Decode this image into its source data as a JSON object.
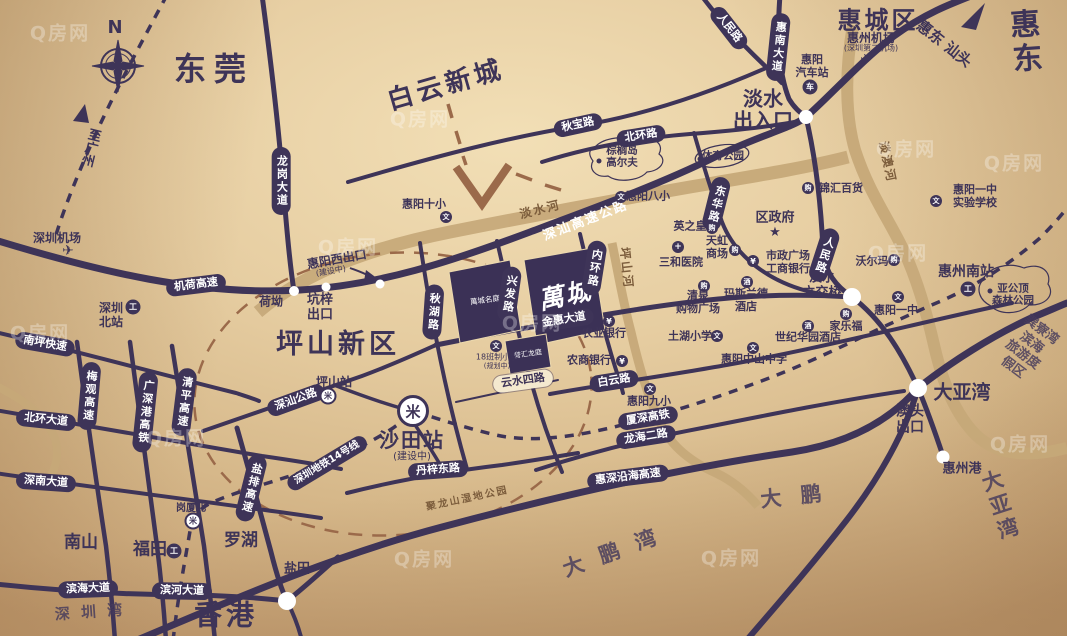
{
  "watermark": "Q房网",
  "compass": {
    "n": "N"
  },
  "project": {
    "name": "萬城",
    "logo": "萬城名庭",
    "mini": "誉汇龙庭"
  },
  "colors": {
    "road": "#3e3458",
    "river": "#c6a878",
    "accent_dash": "#9b6a4a",
    "block": "#3b3156",
    "bg": "#e3cba0"
  },
  "big": [
    {
      "n": "compass-n",
      "t": "N",
      "x": 115,
      "y": 28,
      "s": 18
    },
    {
      "n": "dongguan",
      "t": "东莞",
      "x": 214,
      "y": 70,
      "s": 32,
      "ls": 8
    },
    {
      "n": "baiyun-new-town",
      "t": "白云新城",
      "x": 446,
      "y": 86,
      "s": 26,
      "r": -16,
      "ls": 4
    },
    {
      "n": "huicheng-district",
      "t": "惠城区",
      "x": 878,
      "y": 21,
      "s": 24,
      "ls": 3
    },
    {
      "n": "huidong",
      "t": "惠东",
      "x": 1029,
      "y": 42,
      "s": 30,
      "r": -4,
      "ls": 5
    },
    {
      "n": "huidong-shantou",
      "t": "惠东 汕头",
      "x": 944,
      "y": 44,
      "s": 15,
      "r": 38
    },
    {
      "n": "danshui-entrance",
      "t": "淡水\n出入口",
      "x": 763,
      "y": 110,
      "s": 20
    },
    {
      "n": "pingshan-new-district",
      "t": "坪山新区",
      "x": 338,
      "y": 345,
      "s": 27,
      "ls": 4
    },
    {
      "n": "to-guangzhou",
      "t": "至广州",
      "x": 89,
      "y": 147,
      "s": 13,
      "r": 14,
      "v": 1
    },
    {
      "n": "heao",
      "t": "荷坳",
      "x": 271,
      "y": 302,
      "s": 12
    },
    {
      "n": "kengzi-exit",
      "t": "坑梓\n出口",
      "x": 320,
      "y": 308,
      "s": 13
    },
    {
      "n": "huiyang-west-exit",
      "t": "惠阳西出口",
      "x": 337,
      "y": 260,
      "s": 12,
      "r": -10
    },
    {
      "n": "huiyang-west-exit-status",
      "t": "(建设中)",
      "x": 331,
      "y": 272,
      "s": 8,
      "r": -10,
      "fw": 400
    },
    {
      "n": "danshui-interchange",
      "t": "淡水\n立交桥",
      "x": 822,
      "y": 286,
      "s": 13
    },
    {
      "n": "shatian-station",
      "t": "沙田站",
      "x": 412,
      "y": 440,
      "s": 20,
      "ls": 2
    },
    {
      "n": "shatian-station-status",
      "t": "(建设中)",
      "x": 412,
      "y": 457,
      "s": 10,
      "fw": 400
    },
    {
      "n": "huizhou-south-station",
      "t": "惠州南站",
      "x": 966,
      "y": 273,
      "s": 14
    },
    {
      "n": "daya-bay-junction",
      "t": "大亚湾",
      "x": 962,
      "y": 393,
      "s": 19
    },
    {
      "n": "aotou-exit",
      "t": "澳头\n出口",
      "x": 910,
      "y": 420,
      "s": 14
    },
    {
      "n": "huizhou-port",
      "t": "惠州港",
      "x": 962,
      "y": 470,
      "s": 13
    },
    {
      "n": "nanshan",
      "t": "南山",
      "x": 81,
      "y": 543,
      "s": 17
    },
    {
      "n": "futian",
      "t": "福田",
      "x": 150,
      "y": 550,
      "s": 17
    },
    {
      "n": "luohu",
      "t": "罗湖",
      "x": 241,
      "y": 541,
      "s": 17
    },
    {
      "n": "yantian",
      "t": "盐田",
      "x": 297,
      "y": 570,
      "s": 13
    },
    {
      "n": "hongkong",
      "t": "香港",
      "x": 226,
      "y": 615,
      "s": 28,
      "ls": 4
    }
  ],
  "sea": [
    {
      "n": "shenzhen-bay",
      "t": "深 圳 湾",
      "x": 90,
      "y": 612,
      "s": 15,
      "r": -4,
      "ls": 3
    },
    {
      "n": "dapeng",
      "t": "大 鹏",
      "x": 794,
      "y": 497,
      "s": 21,
      "r": -6,
      "ls": 6
    },
    {
      "n": "dapeng-bay",
      "t": "大 鹏 湾",
      "x": 612,
      "y": 553,
      "s": 21,
      "r": -20,
      "ls": 5
    },
    {
      "n": "daya-bay-sea",
      "t": "大 亚 湾",
      "x": 1003,
      "y": 505,
      "s": 21,
      "r": -18,
      "ls": 5
    },
    {
      "n": "xunliao-resort",
      "t": "巽寮湾滨海\n旅游度假区",
      "x": 1027,
      "y": 349,
      "s": 13,
      "r": 37
    }
  ],
  "pills": [
    {
      "n": "jihe-expwy",
      "t": "机荷高速",
      "x": 196,
      "y": 285,
      "r": -7
    },
    {
      "n": "longgang-ave",
      "t": "龙岗大道",
      "x": 281,
      "y": 181,
      "v": 1
    },
    {
      "n": "nanping-expwy",
      "t": "南坪快速",
      "x": 45,
      "y": 344,
      "r": 10
    },
    {
      "n": "meiguan-expwy",
      "t": "梅观高速",
      "x": 89,
      "y": 396,
      "v": 1,
      "r": 5
    },
    {
      "n": "guangshengang-hsr",
      "t": "广深港高铁",
      "x": 145,
      "y": 412,
      "v": 1,
      "r": 6
    },
    {
      "n": "qingping-expwy",
      "t": "清平高速",
      "x": 184,
      "y": 402,
      "v": 1,
      "r": 7
    },
    {
      "n": "beihuan-ave",
      "t": "北环大道",
      "x": 46,
      "y": 420,
      "r": 6
    },
    {
      "n": "shennan-ave",
      "t": "深南大道",
      "x": 46,
      "y": 482,
      "r": 4
    },
    {
      "n": "yanpai-expwy",
      "t": "盐排高速",
      "x": 251,
      "y": 488,
      "v": 1,
      "r": 14
    },
    {
      "n": "binhai-ave",
      "t": "滨海大道",
      "x": 88,
      "y": 589,
      "r": -2
    },
    {
      "n": "binhe-ave",
      "t": "滨河大道",
      "x": 182,
      "y": 591,
      "r": 1
    },
    {
      "n": "qiubao-rd",
      "t": "秋宝路",
      "x": 578,
      "y": 125,
      "r": -12
    },
    {
      "n": "beihuan-rd",
      "t": "北环路",
      "x": 641,
      "y": 136,
      "r": -9
    },
    {
      "n": "qiuhu-rd",
      "t": "秋湖路",
      "x": 433,
      "y": 312,
      "v": 1,
      "r": 4
    },
    {
      "n": "xingfa-rd",
      "t": "兴发路",
      "x": 509,
      "y": 294,
      "v": 1,
      "r": 8
    },
    {
      "n": "neihuan-rd",
      "t": "内环路",
      "x": 594,
      "y": 268,
      "v": 1,
      "r": 9
    },
    {
      "n": "jinhui-ave",
      "t": "金惠大道",
      "x": 564,
      "y": 320,
      "r": -9
    },
    {
      "n": "baiyun-rd",
      "t": "白云路",
      "x": 614,
      "y": 381,
      "r": -9
    },
    {
      "n": "xiashen-hsr",
      "t": "厦深高铁",
      "x": 648,
      "y": 418,
      "r": -9
    },
    {
      "n": "longhai-2-rd",
      "t": "龙海二路",
      "x": 646,
      "y": 437,
      "r": -9
    },
    {
      "n": "huishen-coastal-expwy",
      "t": "惠深沿海高速",
      "x": 628,
      "y": 477,
      "r": -7
    },
    {
      "n": "danzi-east-rd",
      "t": "丹梓东路",
      "x": 438,
      "y": 470,
      "r": -4
    },
    {
      "n": "shenshan-rd",
      "t": "深汕公路",
      "x": 296,
      "y": 400,
      "r": -20
    },
    {
      "n": "metro-line-14",
      "t": "深圳地铁14号线",
      "x": 327,
      "y": 463,
      "r": -31,
      "s": 10
    },
    {
      "n": "donghua-rd",
      "t": "东华路",
      "x": 716,
      "y": 204,
      "v": 1,
      "r": 14
    },
    {
      "n": "renmin-rd-mid",
      "t": "人民路",
      "x": 824,
      "y": 255,
      "v": 1,
      "r": 18
    },
    {
      "n": "renmin-rd-top",
      "t": "人民路",
      "x": 729,
      "y": 28,
      "r": 52
    },
    {
      "n": "huinan-ave",
      "t": "惠南大道",
      "x": 778,
      "y": 47,
      "v": 1,
      "r": 6
    },
    {
      "n": "yunshui-4-rd",
      "t": "云水四路",
      "x": 523,
      "y": 381,
      "r": -8,
      "light": 1
    }
  ],
  "road_texts": [
    {
      "n": "shenshan-expressway",
      "t": "深汕高速公路",
      "x": 585,
      "y": 219,
      "r": -21,
      "s": 13
    }
  ],
  "river_texts": [
    {
      "n": "danshui-river",
      "t": "淡水河",
      "x": 540,
      "y": 209,
      "r": -14,
      "s": 12
    },
    {
      "n": "danao-river",
      "t": "淡澳河",
      "x": 888,
      "y": 162,
      "r": 78,
      "s": 12
    },
    {
      "n": "pingshan-river",
      "t": "坪山河",
      "x": 627,
      "y": 268,
      "r": 84,
      "s": 12
    },
    {
      "n": "julongshan-wetland-park",
      "t": "聚龙山湿地公园",
      "x": 467,
      "y": 497,
      "r": -12,
      "s": 10
    }
  ],
  "pois": [
    {
      "n": "huizhou-airport",
      "t": "惠州机场",
      "x": 871,
      "y": 38,
      "s": 12
    },
    {
      "n": "huizhou-airport-sub",
      "t": "(深圳第二机场)",
      "x": 871,
      "y": 48,
      "s": 8,
      "fw": 400
    },
    {
      "n": "huiyang-bus-station",
      "t": "惠阳\n汽车站",
      "x": 812,
      "y": 67,
      "s": 11
    },
    {
      "n": "palm-island-golf",
      "t": "棕榈岛\n高尔夫",
      "x": 622,
      "y": 157,
      "s": 10.5
    },
    {
      "n": "sports-park",
      "t": "体育公园",
      "x": 723,
      "y": 156,
      "s": 10.5
    },
    {
      "n": "district-government",
      "t": "区政府",
      "x": 775,
      "y": 218,
      "s": 13
    },
    {
      "n": "huiyang-8-school",
      "t": "惠阳八小",
      "x": 648,
      "y": 197,
      "s": 11
    },
    {
      "n": "huiyang-10-school",
      "t": "惠阳十小",
      "x": 424,
      "y": 205,
      "s": 11
    },
    {
      "n": "jinhui-department-store",
      "t": "锦汇百货",
      "x": 841,
      "y": 189,
      "s": 11
    },
    {
      "n": "huiyang-no1-experimental-school",
      "t": "惠阳一中\n实验学校",
      "x": 975,
      "y": 197,
      "s": 11
    },
    {
      "n": "yingzhihuang",
      "t": "英之皇",
      "x": 690,
      "y": 227,
      "s": 11
    },
    {
      "n": "tianhong-mall",
      "t": "天虹\n商场",
      "x": 717,
      "y": 248,
      "s": 11
    },
    {
      "n": "sanhe-hospital",
      "t": "三和医院",
      "x": 681,
      "y": 263,
      "s": 11
    },
    {
      "n": "civic-plaza-icbc",
      "t": "市政广场\n工商银行",
      "x": 788,
      "y": 263,
      "s": 11
    },
    {
      "n": "walmart",
      "t": "沃尔玛",
      "x": 872,
      "y": 262,
      "s": 11
    },
    {
      "n": "qingquan-mall",
      "t": "清泉\n购物广场",
      "x": 698,
      "y": 303,
      "s": 11
    },
    {
      "n": "maslande-hotel",
      "t": "玛斯兰德\n酒店",
      "x": 746,
      "y": 301,
      "s": 11
    },
    {
      "n": "huiyang-no1-school",
      "t": "惠阳一中",
      "x": 896,
      "y": 311,
      "s": 11
    },
    {
      "n": "carrefour",
      "t": "家乐福",
      "x": 846,
      "y": 327,
      "s": 11
    },
    {
      "n": "tuhu-school",
      "t": "土湖小学",
      "x": 690,
      "y": 337,
      "s": 11
    },
    {
      "n": "century-garden-hotel",
      "t": "世纪华园酒店",
      "x": 808,
      "y": 338,
      "s": 11
    },
    {
      "n": "zhongshan-school",
      "t": "惠阳中山中学",
      "x": 754,
      "y": 360,
      "s": 11
    },
    {
      "n": "agri-bank",
      "t": "农业银行",
      "x": 604,
      "y": 334,
      "s": 11
    },
    {
      "n": "rural-commercial-bank",
      "t": "农商银行",
      "x": 589,
      "y": 361,
      "s": 11
    },
    {
      "n": "huiyang-9-school",
      "t": "惠阳九小",
      "x": 649,
      "y": 402,
      "s": 11
    },
    {
      "n": "yagongding-forest-park",
      "t": "亚公顶\n森林公园",
      "x": 1013,
      "y": 295,
      "s": 10.5
    },
    {
      "n": "shenzhen-airport",
      "t": "深圳机场",
      "x": 57,
      "y": 238,
      "s": 12
    },
    {
      "n": "shenzhen-north-station",
      "t": "深圳\n北站",
      "x": 111,
      "y": 315,
      "s": 12
    },
    {
      "n": "pingshan-station",
      "t": "坪山站",
      "x": 334,
      "y": 382,
      "s": 12
    },
    {
      "n": "gangxia-north",
      "t": "岗厦北",
      "x": 191,
      "y": 509,
      "s": 10
    },
    {
      "n": "planned-school",
      "t": "18班制小学",
      "x": 497,
      "y": 357,
      "s": 8,
      "fw": 400
    },
    {
      "n": "planned-school-sub",
      "t": "(规划中)",
      "x": 497,
      "y": 366,
      "s": 7,
      "fw": 400
    }
  ],
  "icons": [
    {
      "n": "shenzhen-airport-icon",
      "t": "plane",
      "x": 68,
      "y": 251
    },
    {
      "n": "huizhou-airport-icon",
      "t": "plane",
      "x": 866,
      "y": 60
    },
    {
      "n": "huiyang-bus-icon",
      "t": "bus",
      "x": 810,
      "y": 87
    },
    {
      "n": "shenzhen-north-icon",
      "t": "train",
      "x": 133,
      "y": 307
    },
    {
      "n": "futian-rail-icon",
      "t": "train",
      "x": 174,
      "y": 551
    },
    {
      "n": "huizhou-south-icon",
      "t": "train",
      "x": 968,
      "y": 289
    },
    {
      "n": "shatian-metro-icon",
      "t": "metro",
      "x": 413,
      "y": 411,
      "big": 1
    },
    {
      "n": "pingshan-metro-icon",
      "t": "metro",
      "x": 328,
      "y": 396
    },
    {
      "n": "gangxiabei-metro-icon",
      "t": "metro",
      "x": 193,
      "y": 521
    },
    {
      "n": "district-govt-icon",
      "t": "star",
      "x": 775,
      "y": 232
    },
    {
      "n": "golf-dot-icon",
      "t": "dot",
      "x": 599,
      "y": 161
    },
    {
      "n": "sports-park-dot-icon",
      "t": "dot",
      "x": 700,
      "y": 159
    },
    {
      "n": "yagongding-dot-icon",
      "t": "dot",
      "x": 990,
      "y": 291
    },
    {
      "n": "huiyang-8-school-icon",
      "t": "school",
      "x": 621,
      "y": 197
    },
    {
      "n": "huiyang-10-school-icon",
      "t": "school",
      "x": 446,
      "y": 217
    },
    {
      "n": "huiyang-no1-exp-icon",
      "t": "school",
      "x": 936,
      "y": 201
    },
    {
      "n": "huiyang-no1-icon",
      "t": "school",
      "x": 898,
      "y": 297
    },
    {
      "n": "tuhu-school-icon",
      "t": "school",
      "x": 717,
      "y": 336
    },
    {
      "n": "zhongshan-school-icon",
      "t": "school",
      "x": 753,
      "y": 348
    },
    {
      "n": "huiyang-9-school-icon",
      "t": "school",
      "x": 650,
      "y": 389
    },
    {
      "n": "planned-school-icon",
      "t": "school",
      "x": 496,
      "y": 346
    },
    {
      "n": "icbc-icon",
      "t": "bank",
      "x": 753,
      "y": 261
    },
    {
      "n": "agri-bank-icon",
      "t": "bank",
      "x": 609,
      "y": 321
    },
    {
      "n": "rcb-bank-icon",
      "t": "bank",
      "x": 622,
      "y": 361
    },
    {
      "n": "sanhe-hospital-icon",
      "t": "hospital",
      "x": 678,
      "y": 247
    },
    {
      "n": "jinhui-mall-icon",
      "t": "mall",
      "x": 808,
      "y": 188
    },
    {
      "n": "yingzhihuang-icon",
      "t": "mall",
      "x": 712,
      "y": 228
    },
    {
      "n": "tianhong-icon",
      "t": "mall",
      "x": 735,
      "y": 250
    },
    {
      "n": "walmart-icon",
      "t": "mall",
      "x": 894,
      "y": 260
    },
    {
      "n": "qingquan-icon",
      "t": "mall",
      "x": 704,
      "y": 286
    },
    {
      "n": "carrefour-icon",
      "t": "mall",
      "x": 846,
      "y": 314
    },
    {
      "n": "maslande-icon",
      "t": "hotel",
      "x": 747,
      "y": 282
    },
    {
      "n": "century-hotel-icon",
      "t": "hotel",
      "x": 808,
      "y": 326
    }
  ],
  "watermarks": [
    [
      60,
      32
    ],
    [
      420,
      118
    ],
    [
      906,
      148
    ],
    [
      1014,
      162
    ],
    [
      348,
      246
    ],
    [
      898,
      252
    ],
    [
      40,
      332
    ],
    [
      532,
      322
    ],
    [
      176,
      437
    ],
    [
      1020,
      443
    ],
    [
      731,
      557
    ],
    [
      424,
      558
    ]
  ]
}
